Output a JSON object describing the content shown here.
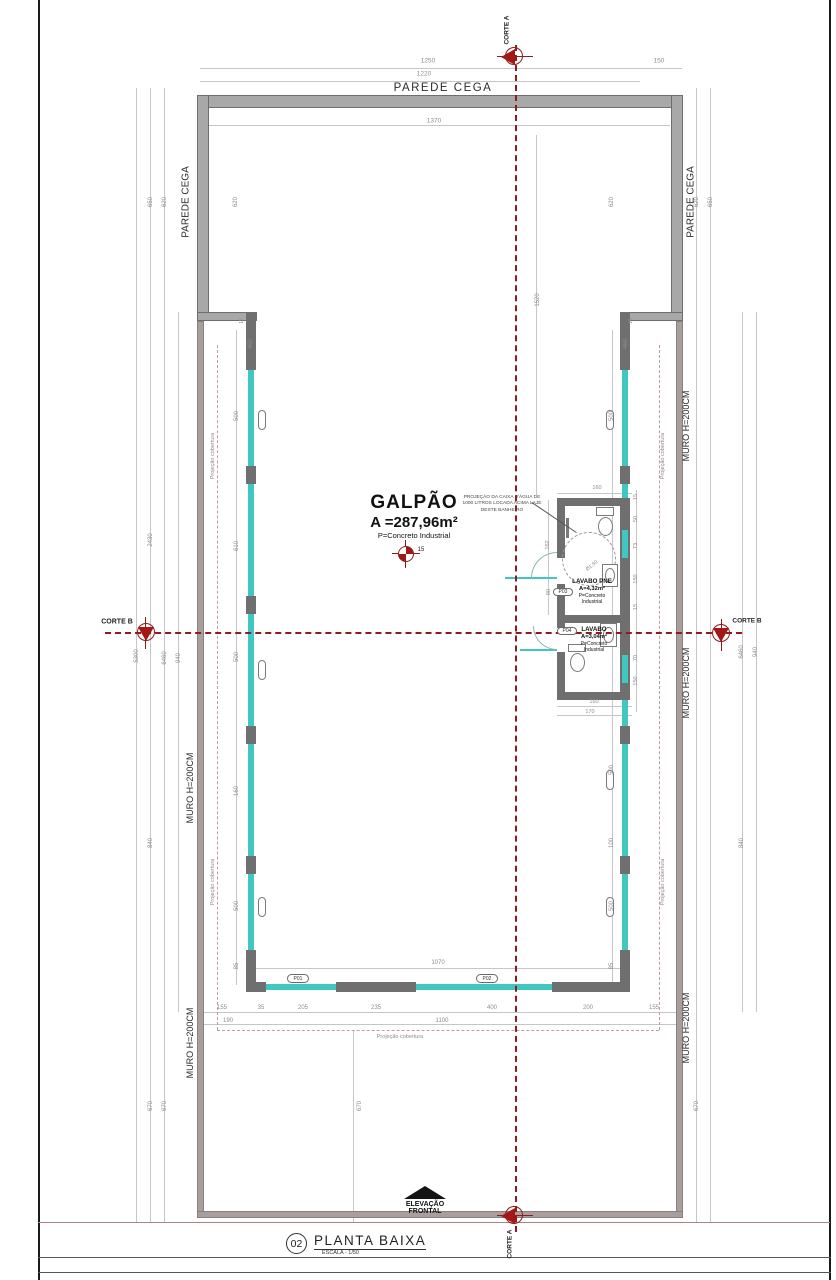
{
  "colors": {
    "wall_dark": "#6f6f6f",
    "parede_fill": "#a8a8a8",
    "muro_fill": "#a89e9e",
    "glass": "#41c7c1",
    "section_red": "#8e1c1c",
    "dimension_gray": "#8d8d8d",
    "coverage_dash": "#c79a9a"
  },
  "sections": {
    "corte_a": "CORTE A",
    "corte_b": "CORTE B"
  },
  "plan": {
    "room": {
      "name": "GALPÃO",
      "area": "A =287,96m²",
      "floor": "P=Concreto Industrial",
      "level": "15"
    },
    "bathrooms": {
      "pne": {
        "name": "LAVABO PNE",
        "area": "A=4,32m²",
        "floor": "P=Concreto Industrial"
      },
      "lavabo": {
        "name": "LAVABO",
        "area": "A=3,04m²",
        "floor": "P=Concreto Industrial"
      }
    },
    "caixa_note": "PROJEÇÃO DA CAIXA D'ÁGUA DE 1000 LITROS LOCADA ACIMA LAJE DESTE BANHEIRO"
  },
  "elevation": {
    "line1": "ELEVAÇÃO",
    "line2": "FRONTAL"
  },
  "title_block": {
    "number": "02",
    "title": "PLANTA BAIXA",
    "scale": "ESCALA - 1/50"
  },
  "tags": [
    "P01",
    "P02",
    "P03",
    "P04"
  ],
  "labels": [
    {
      "id": "dim-1250",
      "t": "1250",
      "x": 428,
      "y": 61,
      "r": 0,
      "s": 6.5,
      "c": "g"
    },
    {
      "id": "dim-150",
      "t": "150",
      "x": 659,
      "y": 61,
      "r": 0,
      "s": 6.5,
      "c": "g"
    },
    {
      "id": "dim-1220",
      "t": "1220",
      "x": 424,
      "y": 74,
      "r": 0,
      "s": 6.5,
      "c": "g"
    },
    {
      "id": "dim-1370",
      "t": "1370",
      "x": 434,
      "y": 121,
      "r": 0,
      "s": 6.5,
      "c": "g"
    },
    {
      "id": "lbl-parede-cega-top",
      "t": "PAREDE CEGA",
      "x": 443,
      "y": 88,
      "r": 0,
      "s": 11.5,
      "c": "k",
      "ls": 1.5
    },
    {
      "id": "lbl-parede-cega-left",
      "t": "PAREDE CEGA",
      "x": 186,
      "y": 202,
      "r": -90,
      "s": 10,
      "c": "k"
    },
    {
      "id": "lbl-parede-cega-right",
      "t": "PAREDE CEGA",
      "x": 691,
      "y": 202,
      "r": -90,
      "s": 10,
      "c": "k"
    },
    {
      "id": "dim-650-l",
      "t": "650",
      "x": 151,
      "y": 202,
      "r": -90,
      "s": 6,
      "c": "g"
    },
    {
      "id": "dim-620-l1",
      "t": "620",
      "x": 165,
      "y": 202,
      "r": -90,
      "s": 6,
      "c": "g"
    },
    {
      "id": "dim-620-l2",
      "t": "620",
      "x": 236,
      "y": 202,
      "r": -90,
      "s": 6,
      "c": "g"
    },
    {
      "id": "dim-620-r1",
      "t": "620",
      "x": 612,
      "y": 202,
      "r": -90,
      "s": 6,
      "c": "g"
    },
    {
      "id": "dim-620-r2",
      "t": "620",
      "x": 697,
      "y": 202,
      "r": -90,
      "s": 6,
      "c": "g"
    },
    {
      "id": "dim-650-r",
      "t": "650",
      "x": 711,
      "y": 202,
      "r": -90,
      "s": 6,
      "c": "g"
    },
    {
      "id": "dim-15-jl",
      "t": "15",
      "x": 242,
      "y": 321,
      "r": -90,
      "s": 5,
      "c": "g"
    },
    {
      "id": "dim-15-jr",
      "t": "15",
      "x": 631,
      "y": 321,
      "r": -90,
      "s": 5,
      "c": "g"
    },
    {
      "id": "dim-460-l",
      "t": "460",
      "x": 251,
      "y": 344,
      "r": -90,
      "s": 6,
      "c": "g"
    },
    {
      "id": "dim-460-r",
      "t": "460",
      "x": 626,
      "y": 344,
      "r": -90,
      "s": 6,
      "c": "g"
    },
    {
      "id": "dim-1520",
      "t": "1520",
      "x": 538,
      "y": 300,
      "r": -90,
      "s": 6,
      "c": "g"
    },
    {
      "id": "dim-2430",
      "t": "2430",
      "x": 151,
      "y": 540,
      "r": -90,
      "s": 6,
      "c": "g"
    },
    {
      "id": "dim-5300",
      "t": "5300",
      "x": 137,
      "y": 656,
      "r": -90,
      "s": 6,
      "c": "g"
    },
    {
      "id": "dim-6460-l",
      "t": "6460",
      "x": 165,
      "y": 658,
      "r": -90,
      "s": 6,
      "c": "g"
    },
    {
      "id": "dim-940-l",
      "t": "940",
      "x": 179,
      "y": 658,
      "r": -90,
      "s": 6,
      "c": "g"
    },
    {
      "id": "dim-6460-r",
      "t": "6460",
      "x": 742,
      "y": 652,
      "r": -90,
      "s": 6,
      "c": "g"
    },
    {
      "id": "dim-940-r",
      "t": "940",
      "x": 756,
      "y": 652,
      "r": -90,
      "s": 6,
      "c": "g"
    },
    {
      "id": "dim-840-l",
      "t": "840",
      "x": 151,
      "y": 843,
      "r": -90,
      "s": 6,
      "c": "g"
    },
    {
      "id": "dim-840-r",
      "t": "840",
      "x": 742,
      "y": 843,
      "r": -90,
      "s": 6,
      "c": "g"
    },
    {
      "id": "dim-500-l1",
      "t": "500",
      "x": 237,
      "y": 416,
      "r": -90,
      "s": 6,
      "c": "g"
    },
    {
      "id": "dim-610-l",
      "t": "610",
      "x": 237,
      "y": 546,
      "r": -90,
      "s": 6,
      "c": "g"
    },
    {
      "id": "dim-500-l2",
      "t": "500",
      "x": 237,
      "y": 657,
      "r": -90,
      "s": 6,
      "c": "g"
    },
    {
      "id": "dim-160-l",
      "t": "160",
      "x": 237,
      "y": 791,
      "r": -90,
      "s": 6,
      "c": "g"
    },
    {
      "id": "dim-500-l3",
      "t": "500",
      "x": 237,
      "y": 906,
      "r": -90,
      "s": 6,
      "c": "g"
    },
    {
      "id": "dim-85-l",
      "t": "85",
      "x": 237,
      "y": 966,
      "r": -90,
      "s": 6,
      "c": "g"
    },
    {
      "id": "dim-500-r1",
      "t": "500",
      "x": 612,
      "y": 416,
      "r": -90,
      "s": 6,
      "c": "g"
    },
    {
      "id": "dim-500-r2",
      "t": "500",
      "x": 612,
      "y": 770,
      "r": -90,
      "s": 6,
      "c": "g"
    },
    {
      "id": "dim-100-r",
      "t": "100",
      "x": 612,
      "y": 843,
      "r": -90,
      "s": 6,
      "c": "g"
    },
    {
      "id": "dim-500-r3",
      "t": "500",
      "x": 612,
      "y": 906,
      "r": -90,
      "s": 6,
      "c": "g"
    },
    {
      "id": "dim-85-r",
      "t": "85",
      "x": 612,
      "y": 966,
      "r": -90,
      "s": 6,
      "c": "g"
    },
    {
      "id": "dim-15-b1",
      "t": "15",
      "x": 636,
      "y": 497,
      "r": -90,
      "s": 5.5,
      "c": "g"
    },
    {
      "id": "dim-50-b",
      "t": "50",
      "x": 636,
      "y": 519,
      "r": -90,
      "s": 5.5,
      "c": "g"
    },
    {
      "id": "dim-73-b",
      "t": "73",
      "x": 636,
      "y": 546,
      "r": -90,
      "s": 5.5,
      "c": "g"
    },
    {
      "id": "dim-150-b1",
      "t": "150",
      "x": 636,
      "y": 579,
      "r": -90,
      "s": 5.5,
      "c": "g"
    },
    {
      "id": "dim-15-b2",
      "t": "15",
      "x": 636,
      "y": 607,
      "r": -90,
      "s": 5.5,
      "c": "g"
    },
    {
      "id": "dim-70-b",
      "t": "70",
      "x": 636,
      "y": 658,
      "r": -90,
      "s": 5.5,
      "c": "g"
    },
    {
      "id": "dim-150-b2",
      "t": "150",
      "x": 636,
      "y": 681,
      "r": -90,
      "s": 5.5,
      "c": "g"
    },
    {
      "id": "dim-162-b",
      "t": "162",
      "x": 548,
      "y": 545,
      "r": -90,
      "s": 5.5,
      "c": "g"
    },
    {
      "id": "dim-90-b",
      "t": "90",
      "x": 549,
      "y": 592,
      "r": -90,
      "s": 5.5,
      "c": "g"
    },
    {
      "id": "dim-160-bt",
      "t": "160",
      "x": 597,
      "y": 488,
      "r": 0,
      "s": 5.5,
      "c": "g"
    },
    {
      "id": "dim-160-bb",
      "t": "160",
      "x": 594,
      "y": 702,
      "r": 0,
      "s": 5.5,
      "c": "g"
    },
    {
      "id": "dim-170-bb",
      "t": "170",
      "x": 590,
      "y": 712,
      "r": 0,
      "s": 5.5,
      "c": "g"
    },
    {
      "id": "dim-diam",
      "t": "Ø1,50",
      "x": 592,
      "y": 566,
      "r": -38,
      "s": 5,
      "c": "g"
    },
    {
      "id": "dim-1070",
      "t": "1070",
      "x": 438,
      "y": 963,
      "r": 0,
      "s": 6,
      "c": "g"
    },
    {
      "id": "dim-155-a",
      "t": "155",
      "x": 222,
      "y": 1008,
      "r": 0,
      "s": 6,
      "c": "g"
    },
    {
      "id": "dim-35",
      "t": "35",
      "x": 261,
      "y": 1008,
      "r": 0,
      "s": 6,
      "c": "g"
    },
    {
      "id": "dim-205",
      "t": "205",
      "x": 303,
      "y": 1008,
      "r": 0,
      "s": 6,
      "c": "g"
    },
    {
      "id": "dim-235",
      "t": "235",
      "x": 376,
      "y": 1008,
      "r": 0,
      "s": 6,
      "c": "g"
    },
    {
      "id": "dim-400",
      "t": "400",
      "x": 492,
      "y": 1008,
      "r": 0,
      "s": 6,
      "c": "g"
    },
    {
      "id": "dim-200",
      "t": "200",
      "x": 588,
      "y": 1008,
      "r": 0,
      "s": 6,
      "c": "g"
    },
    {
      "id": "dim-155-b",
      "t": "155",
      "x": 654,
      "y": 1008,
      "r": 0,
      "s": 6,
      "c": "g"
    },
    {
      "id": "dim-190",
      "t": "190",
      "x": 228,
      "y": 1021,
      "r": 0,
      "s": 6,
      "c": "g"
    },
    {
      "id": "dim-1100",
      "t": "1100",
      "x": 442,
      "y": 1021,
      "r": 0,
      "s": 6,
      "c": "g"
    },
    {
      "id": "dim-670-l1",
      "t": "670",
      "x": 151,
      "y": 1106,
      "r": -90,
      "s": 6,
      "c": "g"
    },
    {
      "id": "dim-670-l2",
      "t": "670",
      "x": 165,
      "y": 1106,
      "r": -90,
      "s": 6,
      "c": "g"
    },
    {
      "id": "dim-670-c",
      "t": "670",
      "x": 360,
      "y": 1106,
      "r": -90,
      "s": 6,
      "c": "g"
    },
    {
      "id": "dim-670-r",
      "t": "670",
      "x": 697,
      "y": 1106,
      "r": -90,
      "s": 6,
      "c": "g"
    },
    {
      "id": "lbl-muro-left-1",
      "t": "MURO H=200CM",
      "x": 190,
      "y": 788,
      "r": -90,
      "s": 9,
      "c": "k"
    },
    {
      "id": "lbl-muro-left-2",
      "t": "MURO H=200CM",
      "x": 190,
      "y": 1043,
      "r": -90,
      "s": 9,
      "c": "k"
    },
    {
      "id": "lbl-muro-right-1",
      "t": "MURO H=200CM",
      "x": 686,
      "y": 426,
      "r": -90,
      "s": 9,
      "c": "k"
    },
    {
      "id": "lbl-muro-right-2",
      "t": "MURO H=200CM",
      "x": 686,
      "y": 683,
      "r": -90,
      "s": 9,
      "c": "k"
    },
    {
      "id": "lbl-muro-right-3",
      "t": "MURO H=200CM",
      "x": 686,
      "y": 1028,
      "r": -90,
      "s": 9,
      "c": "k"
    },
    {
      "id": "lbl-proj-left-1",
      "t": "Projeção cobertura",
      "x": 213,
      "y": 456,
      "r": -90,
      "s": 5.5,
      "c": "g"
    },
    {
      "id": "lbl-proj-left-2",
      "t": "Projeção cobertura",
      "x": 213,
      "y": 882,
      "r": -90,
      "s": 5.5,
      "c": "g"
    },
    {
      "id": "lbl-proj-right-1",
      "t": "Projeção cobertura",
      "x": 663,
      "y": 456,
      "r": -90,
      "s": 5.5,
      "c": "g"
    },
    {
      "id": "lbl-proj-right-2",
      "t": "Projeção cobertura",
      "x": 663,
      "y": 882,
      "r": -90,
      "s": 5.5,
      "c": "g"
    },
    {
      "id": "lbl-proj-bottom",
      "t": "Projeção cobertura",
      "x": 400,
      "y": 1037,
      "r": 0,
      "s": 5.5,
      "c": "g"
    }
  ]
}
